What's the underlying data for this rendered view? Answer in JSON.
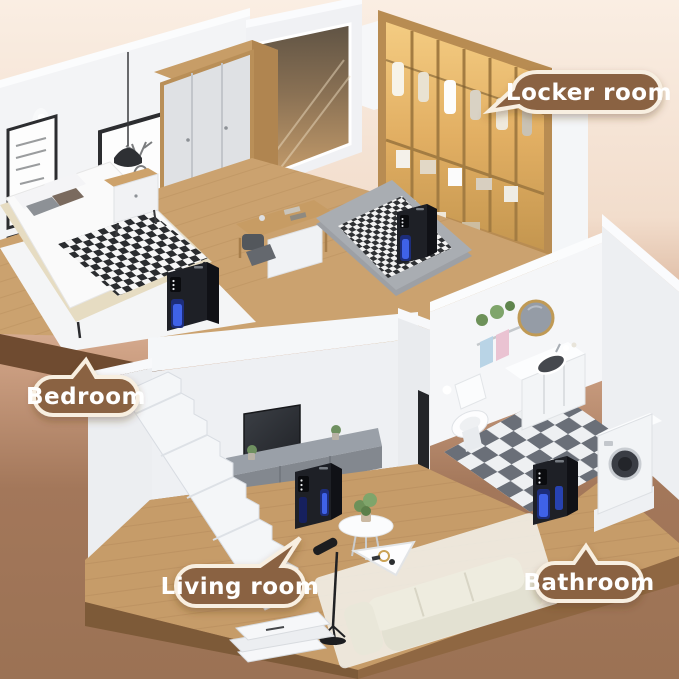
{
  "labels": {
    "locker_room": "Locker room",
    "bedroom": "Bedroom",
    "living_room": "Living room",
    "bathroom": "Bathroom"
  },
  "colors": {
    "background_top": "#f9ece0",
    "background_bottom": "#9b7254",
    "bubble_fill": "#8a6242",
    "bubble_border": "#f8efe1",
    "bubble_text": "#ffffff",
    "wood_floor": "#cba26f",
    "wall_white": "#f2f3f5",
    "closet_glow": "#e8bc72",
    "checker_dark": "#6a6f78",
    "device_body": "#1e2026",
    "device_glow": "#3f62e8"
  },
  "devices": [
    {
      "room": "bedroom"
    },
    {
      "room": "locker_room"
    },
    {
      "room": "living_room"
    },
    {
      "room": "bathroom"
    }
  ]
}
